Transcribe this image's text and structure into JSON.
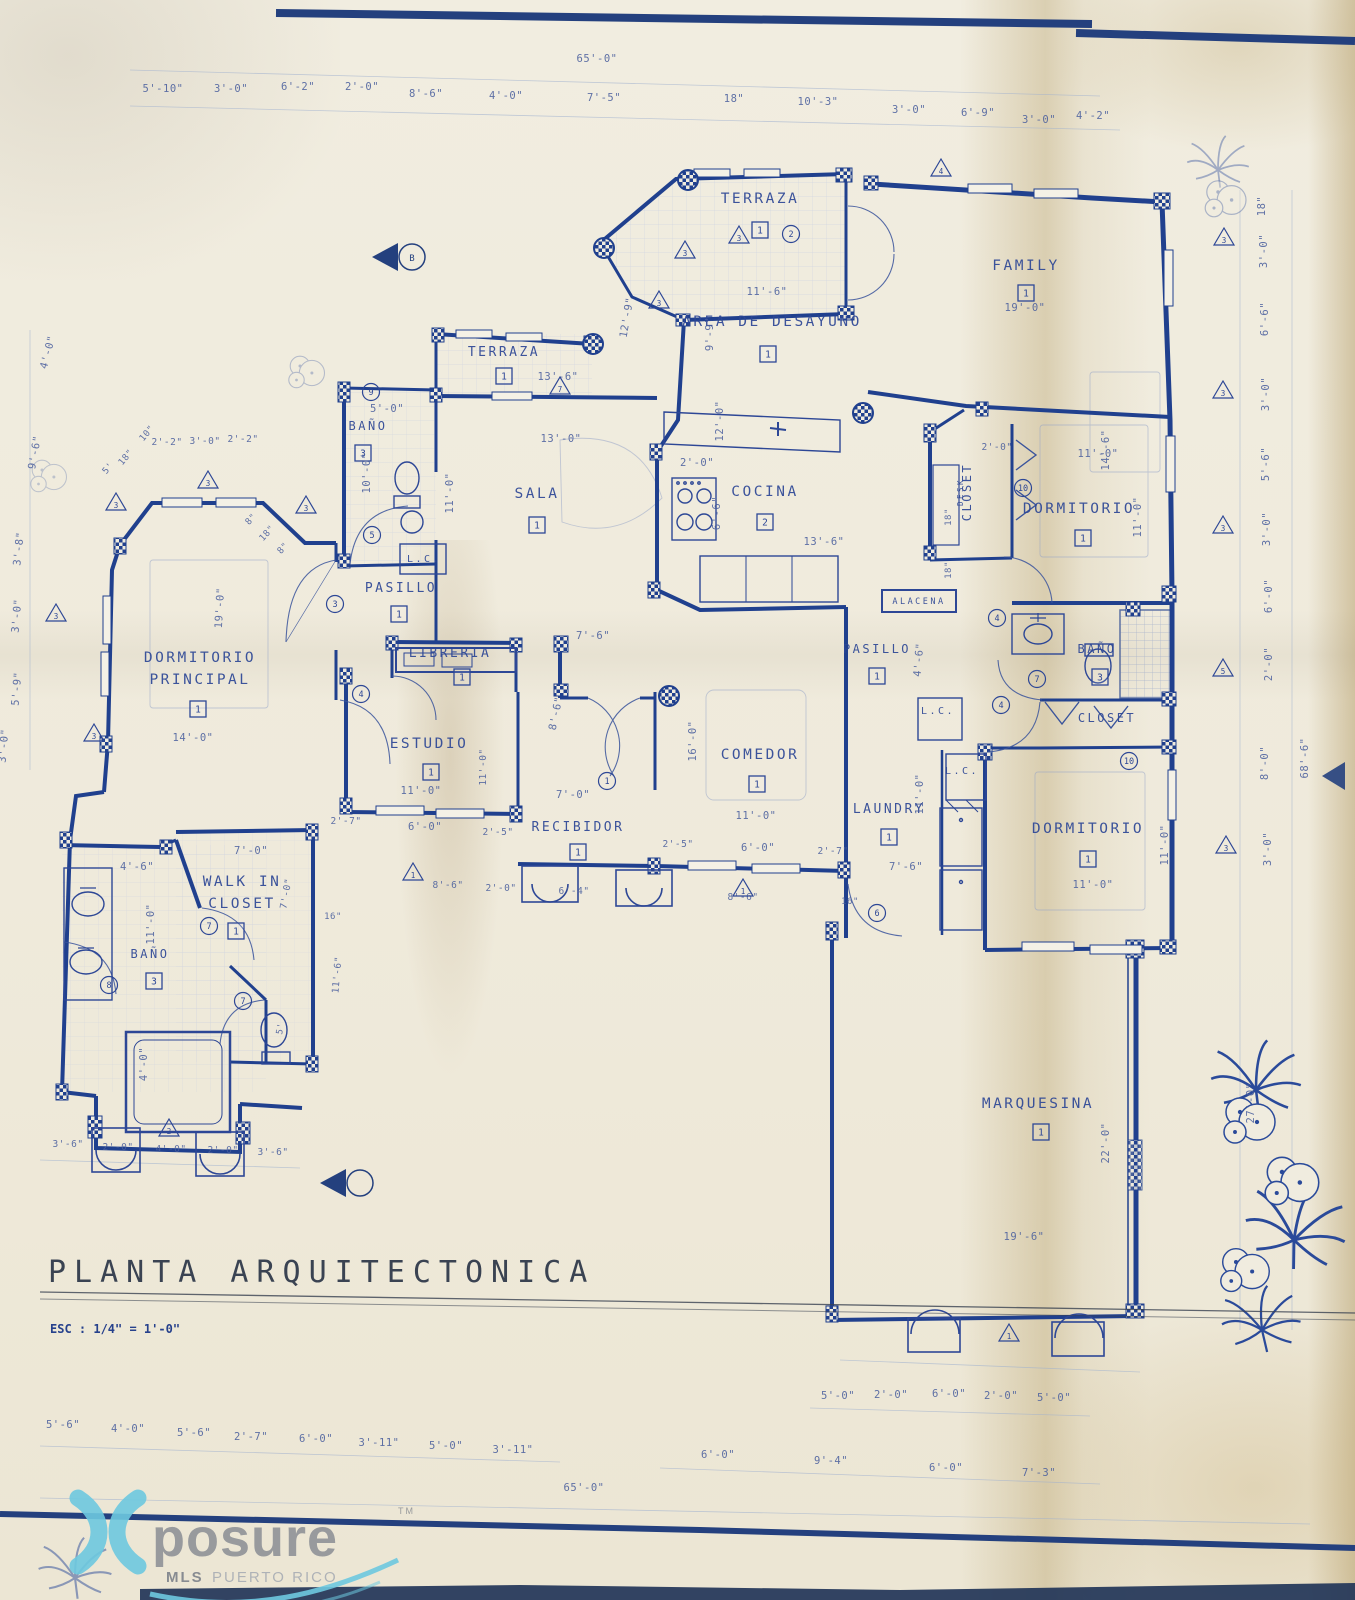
{
  "page": {
    "title": "PLANTA  ARQUITECTONICA",
    "scale_note": "ESC : 1/4\" =  1'-0\""
  },
  "watermark": {
    "brand": "posure",
    "tm": "TM",
    "subtitle_bold": "MLS",
    "subtitle_rest": "PUERTO RICO",
    "cyan": "#6ec9e0",
    "gray": "#8f9298"
  },
  "colors": {
    "ink": "#20408e",
    "label_ink": "#2d4796",
    "paper": "#f0ecdf",
    "fold_tan": "#c9b183"
  },
  "plan": {
    "rooms": [
      {
        "label": "TERRAZA",
        "x": 760,
        "y": 203,
        "tag": "1",
        "tagx": 760,
        "tagy": 230
      },
      {
        "label": "FAMILY",
        "x": 1026,
        "y": 270,
        "tag": "1",
        "tagx": 1026,
        "tagy": 293
      },
      {
        "label": "AREA DE DESAYUNO",
        "x": 772,
        "y": 326,
        "tag": "1",
        "tagx": 768,
        "tagy": 354
      },
      {
        "label": "TERRAZA",
        "x": 504,
        "y": 356,
        "fs": 13,
        "tag": "1",
        "tagx": 504,
        "tagy": 376
      },
      {
        "label": "SALA",
        "x": 537,
        "y": 498,
        "tag": "1",
        "tagx": 537,
        "tagy": 525
      },
      {
        "label": "COCINA",
        "x": 765,
        "y": 496,
        "tag": "2",
        "tagx": 765,
        "tagy": 522
      },
      {
        "label": "BAÑO",
        "x": 368,
        "y": 430,
        "fs": 12,
        "tag": "3",
        "tagx": 363,
        "tagy": 453
      },
      {
        "label": "PASILLO",
        "x": 401,
        "y": 592,
        "fs": 13,
        "tag": "1",
        "tagx": 399,
        "tagy": 614
      },
      {
        "label": "DORMITORIO",
        "label2": "PRINCIPAL",
        "x": 200,
        "y": 662,
        "y2": 684,
        "tag": "1",
        "tagx": 198,
        "tagy": 709
      },
      {
        "label": "LIBRERIA",
        "x": 450,
        "y": 657,
        "fs": 13,
        "tag": "1",
        "tagx": 462,
        "tagy": 677
      },
      {
        "label": "ESTUDIO",
        "x": 429,
        "y": 748,
        "tag": "1",
        "tagx": 431,
        "tagy": 772
      },
      {
        "label": "COMEDOR",
        "x": 760,
        "y": 759,
        "tag": "1",
        "tagx": 757,
        "tagy": 784
      },
      {
        "label": "RECIBIDOR",
        "x": 578,
        "y": 831,
        "fs": 13,
        "tag": "1",
        "tagx": 578,
        "tagy": 852
      },
      {
        "label": "WALK IN",
        "label2": "CLOSET",
        "x": 242,
        "y": 886,
        "y2": 908,
        "tag": "1",
        "tagx": 236,
        "tagy": 931
      },
      {
        "label": "BAÑO",
        "x": 150,
        "y": 958,
        "fs": 12,
        "tag": "3",
        "tagx": 154,
        "tagy": 981
      },
      {
        "label": "LAUNDRY",
        "x": 889,
        "y": 813,
        "fs": 13,
        "tag": "1",
        "tagx": 889,
        "tagy": 837
      },
      {
        "label": "PASILLO",
        "x": 877,
        "y": 653,
        "fs": 12,
        "tag": "1",
        "tagx": 877,
        "tagy": 676
      },
      {
        "label": "ALACENA",
        "x": 919,
        "y": 604,
        "fs": 8.5
      },
      {
        "label": "CLOSET",
        "x": 971,
        "y": 492,
        "fs": 12,
        "rot": -90
      },
      {
        "label": "DESK",
        "x": 963,
        "y": 492,
        "fs": 7.5,
        "rot": -90
      },
      {
        "label": "DORMITORIO",
        "x": 1079,
        "y": 513,
        "tag": "1",
        "tagx": 1083,
        "tagy": 538
      },
      {
        "label": "BAÑO",
        "x": 1097,
        "y": 653,
        "fs": 12,
        "tag": "3",
        "tagx": 1100,
        "tagy": 677
      },
      {
        "label": "CLOSET",
        "x": 1107,
        "y": 722,
        "fs": 12
      },
      {
        "label": "DORMITORIO",
        "x": 1088,
        "y": 833,
        "tag": "1",
        "tagx": 1088,
        "tagy": 859
      },
      {
        "label": "MARQUESINA",
        "x": 1038,
        "y": 1108,
        "tag": "1",
        "tagx": 1041,
        "tagy": 1132
      },
      {
        "label": "L.C.",
        "x": 424,
        "y": 562,
        "fs": 10
      },
      {
        "label": "L.C.",
        "x": 938,
        "y": 714,
        "fs": 10
      },
      {
        "label": "L.C.",
        "x": 962,
        "y": 774,
        "fs": 10
      }
    ],
    "dims": [
      [
        "65'-0\"",
        597,
        62
      ],
      [
        "5'-10\"",
        163,
        92
      ],
      [
        "3'-0\"",
        231,
        92
      ],
      [
        "6'-2\"",
        298,
        90
      ],
      [
        "2'-0\"",
        362,
        90
      ],
      [
        "8'-6\"",
        426,
        97
      ],
      [
        "4'-0\"",
        506,
        99
      ],
      [
        "7'-5\"",
        604,
        101
      ],
      [
        "18\"",
        734,
        102
      ],
      [
        "10'-3\"",
        818,
        105
      ],
      [
        "3'-0\"",
        909,
        113
      ],
      [
        "6'-9\"",
        978,
        116
      ],
      [
        "3'-0\"",
        1039,
        123
      ],
      [
        "4'-2\"",
        1093,
        119
      ],
      [
        "11'-6\"",
        767,
        295
      ],
      [
        "19'-0\"",
        1025,
        311
      ],
      [
        "9'-9\"",
        713,
        334,
        -90
      ],
      [
        "12'-9\"",
        630,
        318,
        -80
      ],
      [
        "14'-6\"",
        1109,
        450,
        -90
      ],
      [
        "13'-6\"",
        558,
        380
      ],
      [
        "13'-0\"",
        561,
        442
      ],
      [
        "12'-0\"",
        723,
        421,
        -90
      ],
      [
        "2'-0\"",
        697,
        466
      ],
      [
        "6'-6\"",
        720,
        513,
        -90
      ],
      [
        "13'-6\"",
        824,
        545
      ],
      [
        "5'-0\"",
        387,
        412
      ],
      [
        "10'-0\"",
        370,
        473,
        -90
      ],
      [
        "11'-0\"",
        453,
        493,
        -90
      ],
      [
        "2'-2\"",
        167,
        445,
        0,
        9.5
      ],
      [
        "3'-0\"",
        205,
        444,
        0,
        9.5
      ],
      [
        "2'-2\"",
        243,
        442,
        0,
        9.5
      ],
      [
        "18\"",
        128,
        459,
        -50,
        9
      ],
      [
        "5'",
        110,
        470,
        -50,
        9
      ],
      [
        "10\"",
        149,
        435,
        -50,
        9
      ],
      [
        "8\"",
        253,
        521,
        -48,
        9
      ],
      [
        "18\"",
        269,
        535,
        -48,
        9
      ],
      [
        "8\"",
        285,
        550,
        -48,
        9
      ],
      [
        "19'-0\"",
        223,
        608,
        -87
      ],
      [
        "14'-0\"",
        193,
        741
      ],
      [
        "7'-6\"",
        593,
        639
      ],
      [
        "8'-6\"",
        559,
        714,
        -78
      ],
      [
        "16'-0\"",
        696,
        741,
        -90
      ],
      [
        "11'-0\"",
        421,
        794
      ],
      [
        "6'-0\"",
        425,
        830
      ],
      [
        "2'-5\"",
        498,
        835,
        0,
        9.5
      ],
      [
        "2'-7\"",
        346,
        824,
        0,
        9.5
      ],
      [
        "11'-0\"",
        486,
        767,
        -90,
        9.5
      ],
      [
        "7'-0\"",
        573,
        798
      ],
      [
        "2'-5\"",
        678,
        847,
        0,
        9.5
      ],
      [
        "6'-0\"",
        758,
        851
      ],
      [
        "2'-7\"",
        833,
        854,
        0,
        9.5
      ],
      [
        "11'-0\"",
        756,
        819
      ],
      [
        "8'-6\"",
        448,
        888,
        0,
        9.5
      ],
      [
        "2'-0\"",
        501,
        891,
        0,
        9.5
      ],
      [
        "6'-4\"",
        574,
        894,
        0,
        9.5
      ],
      [
        "8'-6\"",
        743,
        900,
        0,
        9.5
      ],
      [
        "16\"",
        850,
        904,
        0,
        9
      ],
      [
        "4'-6\"",
        922,
        660,
        -85
      ],
      [
        "7'-6\"",
        906,
        870
      ],
      [
        "11'-0\"",
        923,
        794,
        -90
      ],
      [
        "11'-0\"",
        1098,
        457
      ],
      [
        "11'-0\"",
        1141,
        517,
        -90
      ],
      [
        "2'-0\"",
        997,
        450,
        0,
        9.5
      ],
      [
        "18\"",
        951,
        517,
        -90,
        9
      ],
      [
        "18\"",
        951,
        570,
        -90,
        9
      ],
      [
        "11'-0\"",
        1093,
        888
      ],
      [
        "11'-0\"",
        1168,
        845,
        -90
      ],
      [
        "7'-0\"",
        251,
        854
      ],
      [
        "4'-6\"",
        137,
        870
      ],
      [
        "11'-0\"",
        154,
        924,
        -90
      ],
      [
        "7'-0\"",
        289,
        894,
        -80,
        9.5
      ],
      [
        "16\"",
        333,
        919,
        0,
        9
      ],
      [
        "11'-6\"",
        340,
        975,
        -85,
        9.5
      ],
      [
        "5'",
        283,
        1029,
        -80,
        9
      ],
      [
        "4'-0\"",
        147,
        1064,
        -90
      ],
      [
        "22'-0\"",
        1109,
        1143,
        -90
      ],
      [
        "19'-6\"",
        1024,
        1240
      ],
      [
        "27'-0\"",
        1254,
        1103,
        -90
      ],
      [
        "3'-6\"",
        68,
        1147,
        0,
        9.5
      ],
      [
        "2'-0\"",
        118,
        1150,
        0,
        9.5
      ],
      [
        "4'-0\"",
        171,
        1152,
        0,
        9.5
      ],
      [
        "2'-0\"",
        223,
        1153,
        0,
        9.5
      ],
      [
        "3'-6\"",
        273,
        1155,
        0,
        9.5
      ],
      [
        "5'-0\"",
        838,
        1399
      ],
      [
        "2'-0\"",
        891,
        1398
      ],
      [
        "6'-0\"",
        949,
        1397
      ],
      [
        "2'-0\"",
        1001,
        1399
      ],
      [
        "5'-0\"",
        1054,
        1401
      ],
      [
        "5'-6\"",
        63,
        1428
      ],
      [
        "4'-0\"",
        128,
        1432
      ],
      [
        "5'-6\"",
        194,
        1436
      ],
      [
        "2'-7\"",
        251,
        1440
      ],
      [
        "6'-0\"",
        316,
        1442
      ],
      [
        "3'-11\"",
        379,
        1446
      ],
      [
        "5'-0\"",
        446,
        1449
      ],
      [
        "3'-11\"",
        513,
        1453
      ],
      [
        "6'-0\"",
        718,
        1458
      ],
      [
        "9'-4\"",
        831,
        1464
      ],
      [
        "6'-0\"",
        946,
        1471
      ],
      [
        "7'-3\"",
        1039,
        1476
      ],
      [
        "65'-0\"",
        584,
        1491
      ],
      [
        "4'-0\"",
        51,
        353,
        -75
      ],
      [
        "9'-6\"",
        38,
        453,
        -80
      ],
      [
        "3'-8\"",
        22,
        549,
        -84
      ],
      [
        "3'-0\"",
        20,
        616,
        -85
      ],
      [
        "5'-9\"",
        20,
        689,
        -85
      ],
      [
        "3'-0\"",
        7,
        746,
        -85
      ],
      [
        "18\"",
        1265,
        206,
        -90
      ],
      [
        "3'-0\"",
        1267,
        251,
        -90
      ],
      [
        "6'-6\"",
        1268,
        319,
        -90
      ],
      [
        "3'-0\"",
        1269,
        394,
        -90
      ],
      [
        "5'-6\"",
        1269,
        464,
        -90
      ],
      [
        "3'-0\"",
        1270,
        529,
        -90
      ],
      [
        "6'-0\"",
        1272,
        596,
        -90
      ],
      [
        "2'-0\"",
        1272,
        664,
        -90
      ],
      [
        "8'-0\"",
        1268,
        763,
        -90
      ],
      [
        "68'-6\"",
        1308,
        758,
        -90
      ],
      [
        "3'-0\"",
        1271,
        849,
        -90
      ]
    ],
    "circled_notes": [
      [
        "2",
        791,
        234
      ],
      [
        "9",
        371,
        392
      ],
      [
        "5",
        372,
        535
      ],
      [
        "3",
        335,
        604
      ],
      [
        "4",
        361,
        694
      ],
      [
        "1",
        607,
        781
      ],
      [
        "6",
        877,
        913
      ],
      [
        "4",
        997,
        618
      ],
      [
        "7",
        1037,
        679
      ],
      [
        "4",
        1001,
        705
      ],
      [
        "10",
        1023,
        488
      ],
      [
        "10",
        1129,
        761
      ],
      [
        "8",
        109,
        985
      ],
      [
        "7",
        209,
        926
      ],
      [
        "7",
        243,
        1001
      ]
    ],
    "triangle_notes": [
      [
        "4",
        941,
        169
      ],
      [
        "3",
        739,
        236
      ],
      [
        "3",
        685,
        251
      ],
      [
        "3",
        659,
        301
      ],
      [
        "7",
        560,
        387
      ],
      [
        "3",
        208,
        481
      ],
      [
        "3",
        116,
        503
      ],
      [
        "3",
        306,
        506
      ],
      [
        "3",
        56,
        614
      ],
      [
        "3",
        94,
        734
      ],
      [
        "3",
        1224,
        238
      ],
      [
        "3",
        1223,
        391
      ],
      [
        "3",
        1223,
        526
      ],
      [
        "5",
        1223,
        669
      ],
      [
        "3",
        1226,
        846
      ],
      [
        "2",
        169,
        1129
      ],
      [
        "1",
        413,
        873
      ],
      [
        "1",
        743,
        889
      ],
      [
        "1",
        1009,
        1334
      ]
    ],
    "columns": [
      [
        688,
        180
      ],
      [
        604,
        248
      ],
      [
        593,
        344
      ],
      [
        863,
        413
      ],
      [
        669,
        696
      ]
    ],
    "section_marker_letter": "B"
  }
}
